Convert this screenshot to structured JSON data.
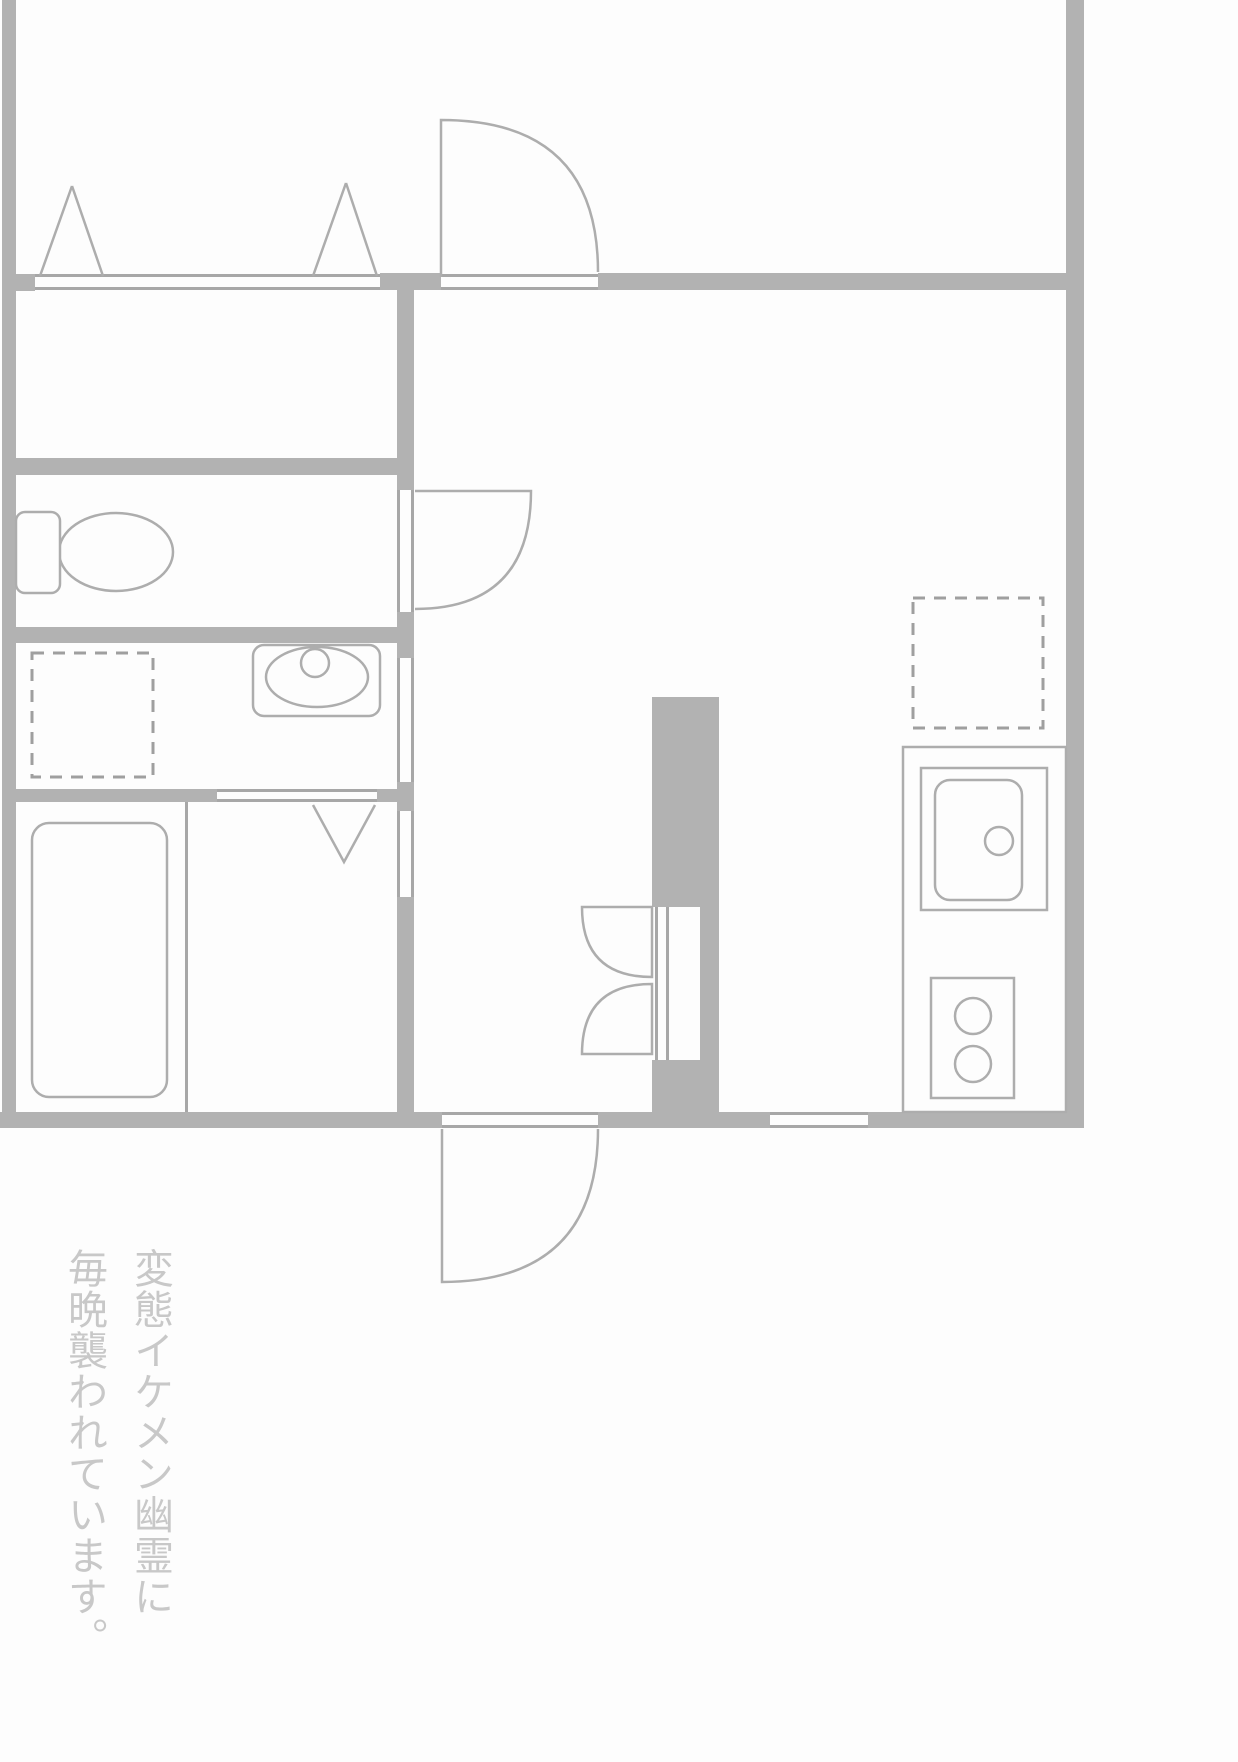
{
  "caption": {
    "text": "変態イケメン幽霊に\n毎晩襲われています。"
  },
  "colors": {
    "background": "#fdfdfd",
    "wall": "#b2b2b2",
    "thin_line": "#a7a7a7",
    "fixture_stroke": "#adadad",
    "caption_text": "#c8c8c8"
  },
  "fixtures": [
    "toilet",
    "bathtub",
    "washroom-sink",
    "washing-machine-space",
    "kitchen-counter",
    "kitchen-sink",
    "stove",
    "refrigerator-space",
    "entrance-door",
    "toilet-door",
    "balcony-door",
    "folding-door",
    "window-top",
    "window-bottom"
  ]
}
